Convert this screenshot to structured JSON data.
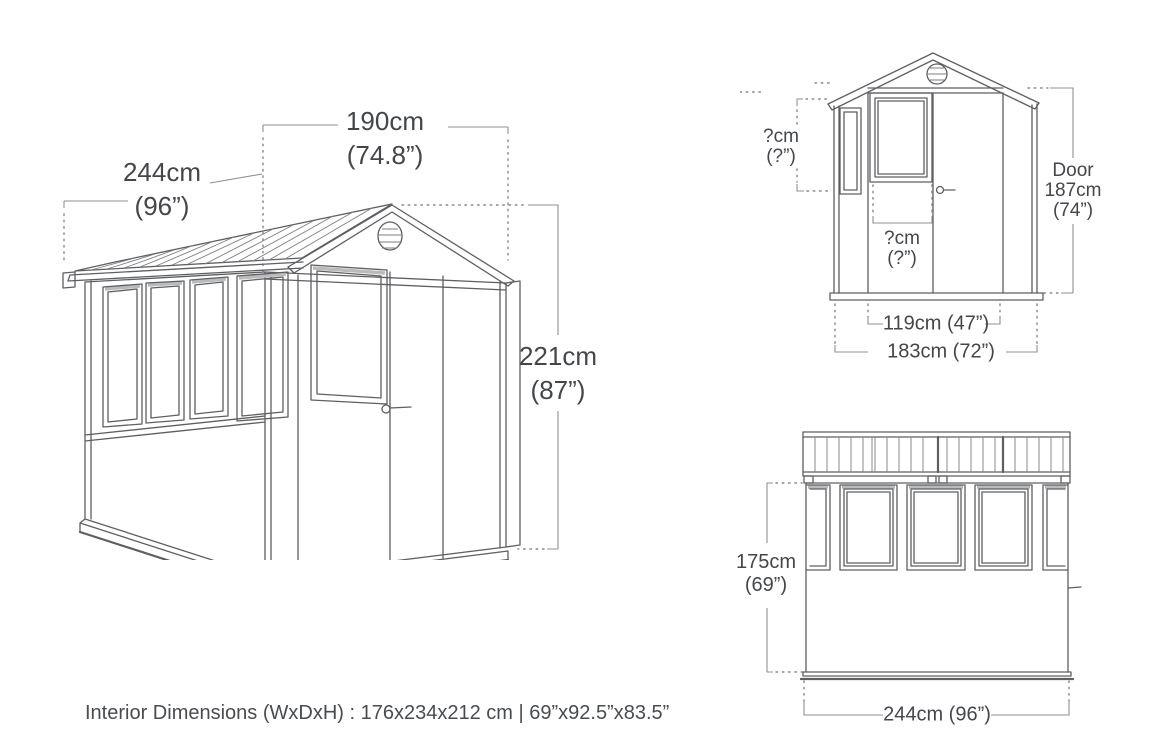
{
  "caption": "Interior Dimensions (WxDxH) : 176x234x212 cm | 69”x92.5”x83.5”",
  "colors": {
    "text": "#43464a",
    "drawing_line": "#5d5f62",
    "dimension_line": "#8d9093",
    "frame_shading": "#b9bbbd",
    "background": "#ffffff"
  },
  "isometric_view": {
    "width_label": {
      "cm": "190cm",
      "inches": "(74.8”)"
    },
    "depth_label": {
      "cm": "244cm",
      "inches": "(96”)"
    },
    "height_label": {
      "cm": "221cm",
      "inches": "(87”)"
    }
  },
  "front_view": {
    "side_window_height_label": {
      "cm": "?cm",
      "inches": "(?”)"
    },
    "door_window_width_label": {
      "cm": "?cm",
      "inches": "(?”)"
    },
    "door_height_label": {
      "title": "Door",
      "cm": "187cm",
      "inches": "(74”)"
    },
    "door_width_label": "119cm (47”)",
    "overall_width_label": "183cm (72”)"
  },
  "side_view": {
    "wall_height_label": {
      "cm": "175cm",
      "inches": "(69”)"
    },
    "overall_width_label": "244cm (96”)"
  }
}
